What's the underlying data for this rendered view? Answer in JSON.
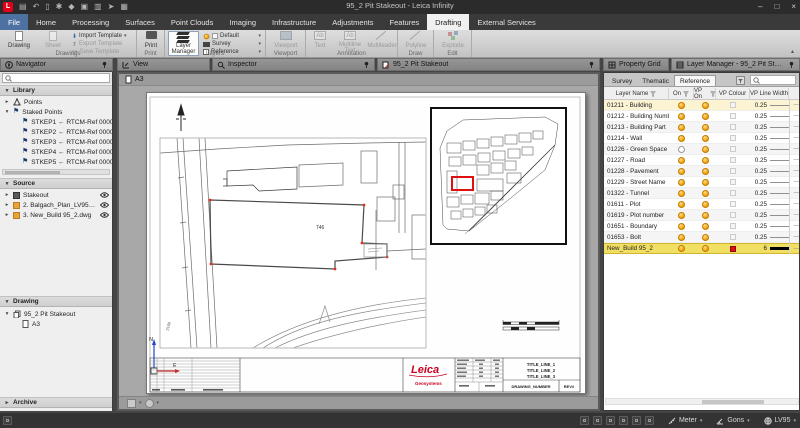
{
  "titlebar": {
    "title": "95_2 Pit Stakeout - Leica Infinity"
  },
  "ribbon": {
    "tabs": [
      {
        "label": "File",
        "is_file": true
      },
      {
        "label": "Home"
      },
      {
        "label": "Processing"
      },
      {
        "label": "Surfaces"
      },
      {
        "label": "Point Clouds"
      },
      {
        "label": "Imaging"
      },
      {
        "label": "Infrastructure"
      },
      {
        "label": "Adjustments"
      },
      {
        "label": "Features"
      },
      {
        "label": "Drafting",
        "is_active": true
      },
      {
        "label": "External Services"
      }
    ],
    "drawings": {
      "caption": "Drawings",
      "drawing": "Drawing",
      "sheet": "Sheet",
      "import_template": "Import Template",
      "export_template": "Export Template",
      "save_template": "Save Template"
    },
    "print": {
      "caption": "Print",
      "print": "Print"
    },
    "layers": {
      "caption": "Layers",
      "layer_manager": "Layer Manager",
      "default": "Default",
      "survey": "Survey",
      "reference": "Reference"
    },
    "viewport": {
      "caption": "Viewport",
      "viewport": "Viewport"
    },
    "annotation": {
      "caption": "Annotation",
      "text": "Text",
      "multiline_text": "Multiline Text",
      "multileader": "Multileader"
    },
    "draw": {
      "caption": "Draw",
      "polyline": "Polyline"
    },
    "edit": {
      "caption": "Edit",
      "explode": "Explode"
    }
  },
  "navigator": {
    "title": "Navigator",
    "library_label": "Library",
    "points_label": "Points",
    "staked_points_label": "Staked Points",
    "staked_points": [
      {
        "label": "STKEP1 ← RTCM-Ref 0000 (07/10"
      },
      {
        "label": "STKEP2 ← RTCM-Ref 0000 (07/10"
      },
      {
        "label": "STKEP3 ← RTCM-Ref 0000 (07/10"
      },
      {
        "label": "STKEP4 ← RTCM-Ref 0000 (07/10"
      },
      {
        "label": "STKEP5 ← RTCM-Ref 0000 (07/10"
      }
    ],
    "source_label": "Source",
    "source_items": [
      {
        "label": "Stakeout",
        "dwg": false
      },
      {
        "label": "2. Balgach_Plan_LV95_2.dwg",
        "dwg": true
      },
      {
        "label": "3. New_Build 95_2.dwg",
        "dwg": true
      }
    ],
    "drawing_label": "Drawing",
    "drawing_item": "95_2 Pit Stakeout",
    "sheet_item": "A3",
    "archive_label": "Archive"
  },
  "view": {
    "tab_view": "View",
    "tab_inspector": "Inspector",
    "tab_drawing": "95_2 Pit Stakeout",
    "sheet_tab": "A3",
    "labels": {
      "parcel": "746",
      "road": "2160",
      "north": "N",
      "east": "E"
    },
    "titleblock": {
      "logo": "Leica",
      "logo_sub": "Geosystems",
      "title1": "TITLE_LINE_1",
      "title2": "TITLE_LINE_2",
      "title3": "TITLE_LINE_3",
      "drawing_number": "DRAWING_NUMBER",
      "rev": "REV#"
    }
  },
  "property_grid": {
    "title": "Property Grid"
  },
  "layer_manager": {
    "title": "Layer Manager - 95_2 Pit Stakeout - A3",
    "tabs": [
      {
        "label": "Survey"
      },
      {
        "label": "Thematic"
      },
      {
        "label": "Reference",
        "is_active": true
      }
    ],
    "columns": {
      "name": "Layer Name",
      "on": "On",
      "vp_on": "VP On",
      "colour": "VP Colour",
      "width": "VP Line Width"
    },
    "rows": [
      {
        "name": "01211 - Building",
        "width": "0.25",
        "sel": true
      },
      {
        "name": "01212 - Building Number",
        "width": "0.25"
      },
      {
        "name": "01213 - Building Part",
        "width": "0.25"
      },
      {
        "name": "01214 - Wall",
        "width": "0.25"
      },
      {
        "name": "01226 - Green Space",
        "width": "0.25",
        "off": true
      },
      {
        "name": "01227 - Road",
        "width": "0.25"
      },
      {
        "name": "01228 - Pavement",
        "width": "0.25"
      },
      {
        "name": "01229 - Street Name",
        "width": "0.25"
      },
      {
        "name": "01322 - Tunnel",
        "width": "0.25"
      },
      {
        "name": "01611 - Plot",
        "width": "0.25"
      },
      {
        "name": "01619 - Plot number",
        "width": "0.25"
      },
      {
        "name": "01651 - Boundary",
        "width": "0.25"
      },
      {
        "name": "01653 - Bolt",
        "width": "0.25"
      },
      {
        "name": "New_Build 95_2",
        "width": "6",
        "red": true,
        "thick": true,
        "hl": true
      }
    ]
  },
  "statusbar": {
    "units": [
      {
        "label": "Meter"
      },
      {
        "label": "Gons"
      },
      {
        "label": "LV95"
      }
    ]
  },
  "accent": {
    "leica_red": "#e2001a",
    "highlight_yellow": "#f1df63",
    "bulb_orange": "#f59d00"
  }
}
